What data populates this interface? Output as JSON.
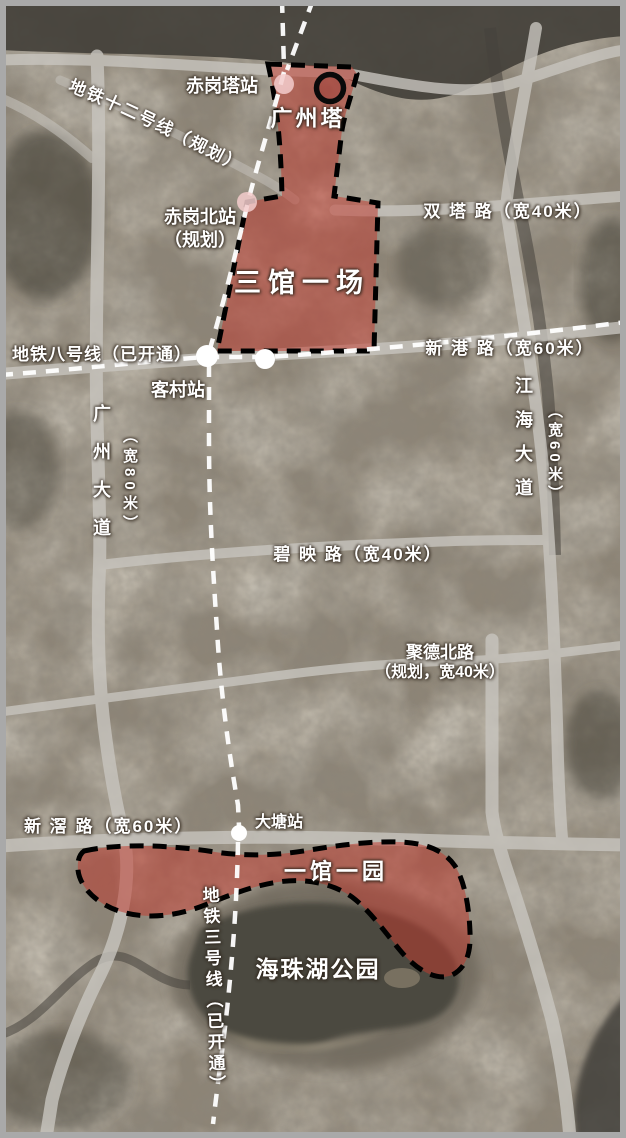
{
  "map": {
    "landmarks": {
      "canton_tower": "广州塔",
      "haizhu_park": "海珠湖公园"
    },
    "regions": {
      "sanguan_yichang": "三馆一场",
      "yiguan_yiyuan": "一馆一园"
    },
    "stations": {
      "chigangta": "赤岗塔站",
      "chigangbei_line1": "赤岗北站",
      "chigangbei_line2": "（规划）",
      "kecun": "客村站",
      "datang": "大塘站"
    },
    "metro_lines": {
      "line12": "地铁十二号线（规划）",
      "line8": "地铁八号线（已开通）",
      "line3": "地铁三号线（已开通）"
    },
    "roads": {
      "shuangta": "双 塔 路（宽40米）",
      "xingang": "新 港 路（宽60米）",
      "biying": "碧 映 路（宽40米）",
      "jude_line1": "聚德北路",
      "jude_line2": "（规划，宽40米）",
      "xinjiao": "新 滘 路（宽60米）",
      "guangzhou_avenue": "广州大道",
      "guangzhou_avenue_width": "（宽80米）",
      "jianghai_avenue": "江海大道",
      "jianghai_avenue_width": "（宽60米）"
    },
    "colors": {
      "background_sepia": "#8e8576",
      "water_dark": "#45423a",
      "road_gray": "#c8c5bf",
      "region_red_fill": "#c03a2e",
      "region_border_black": "#000000",
      "metro_line_white": "#ffffff",
      "station_dot_pink": "#f3cdcd",
      "station_dot_white": "#ffffff",
      "frame_gray": "#a9a9a9"
    }
  }
}
